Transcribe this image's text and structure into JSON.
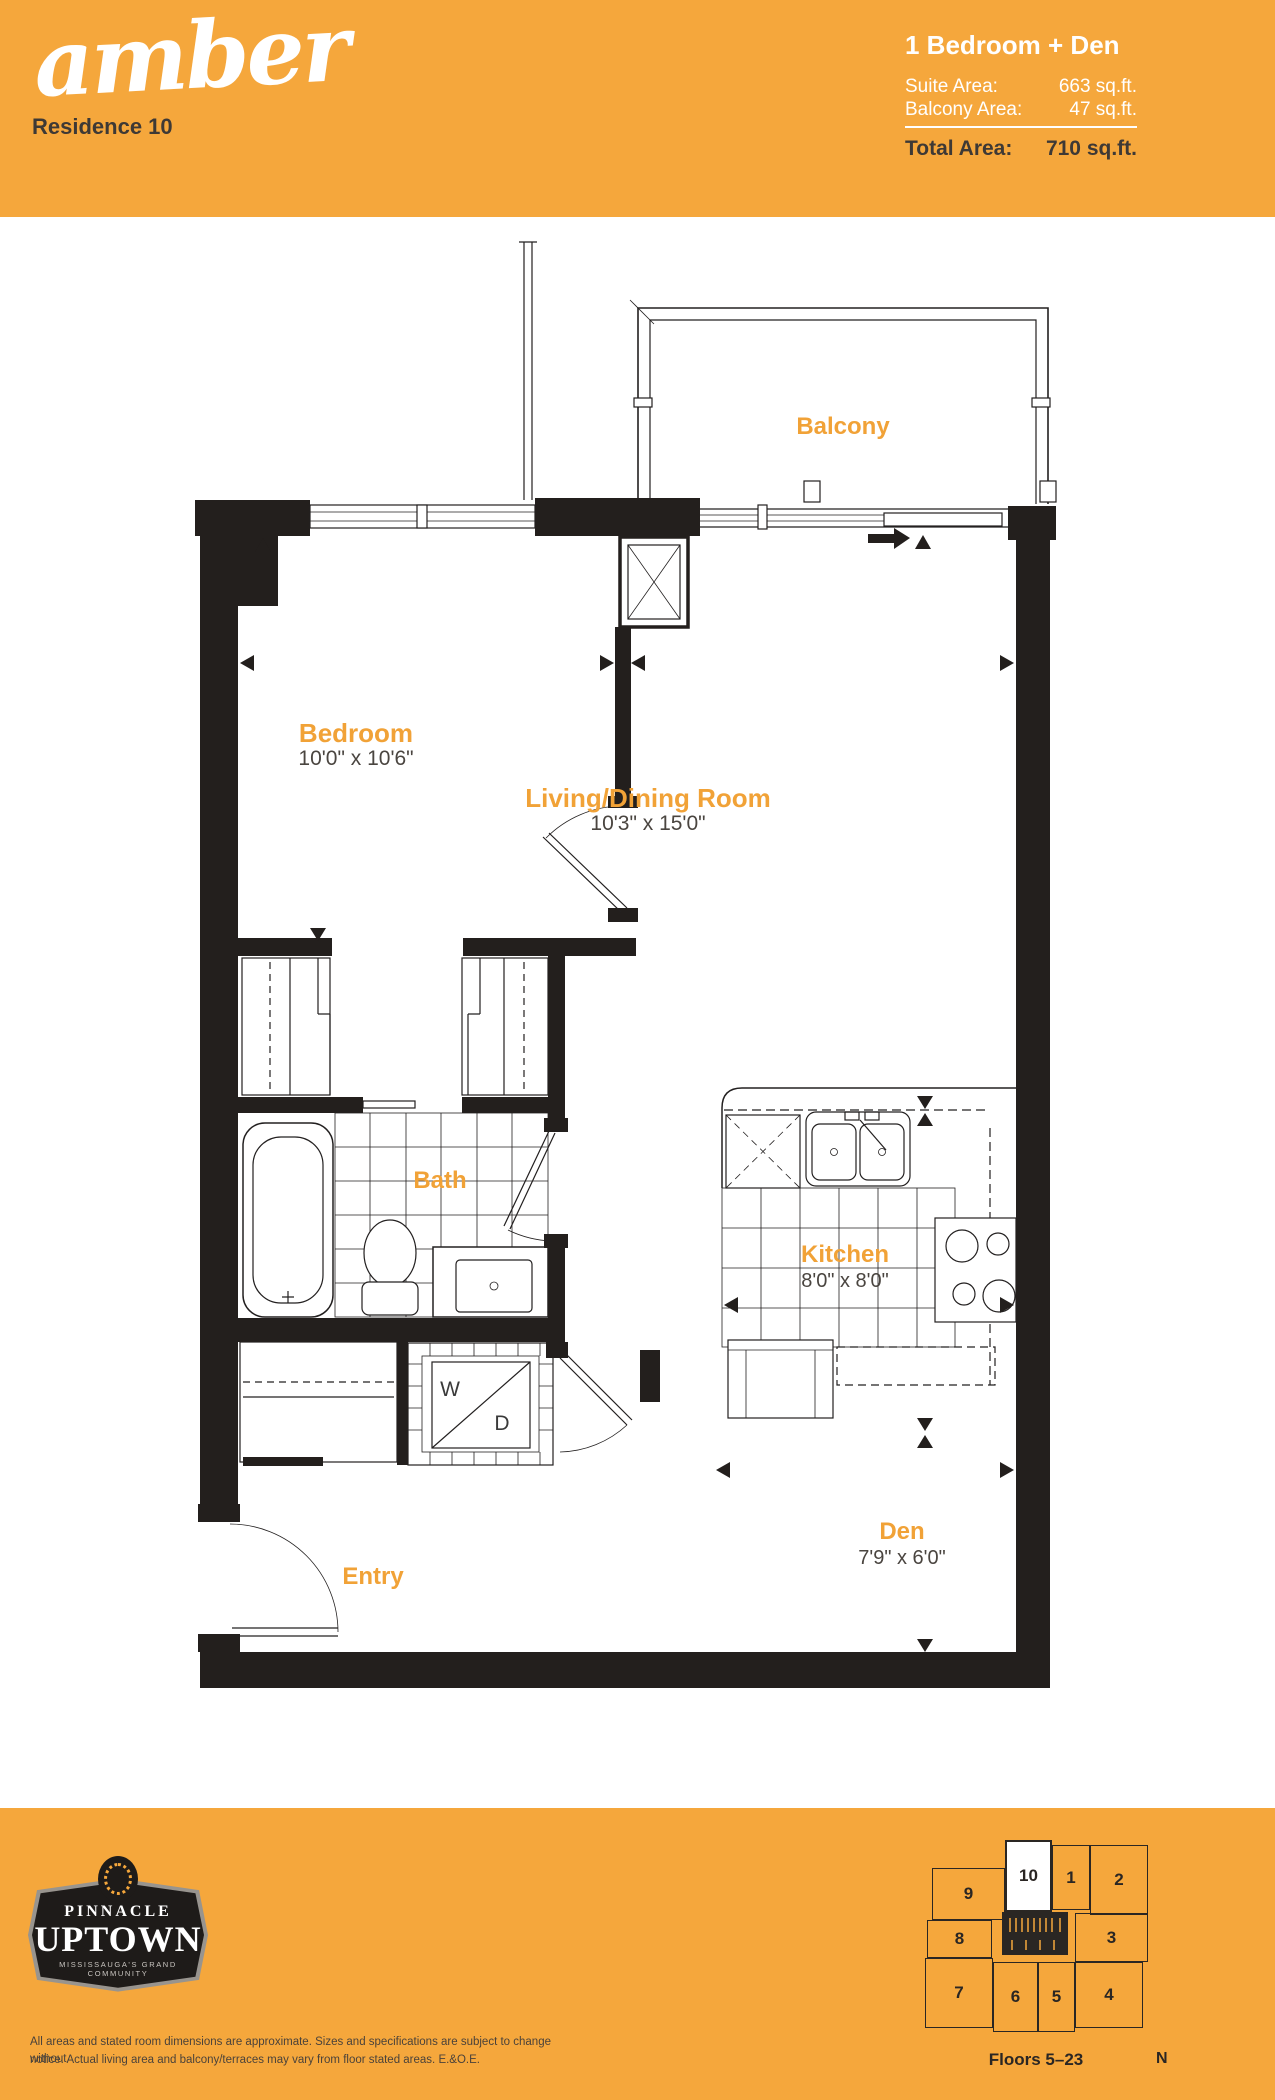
{
  "header": {
    "brand": "amber",
    "residence": "Residence 10",
    "unit_type": "1 Bedroom + Den",
    "suite_area_label": "Suite Area:",
    "suite_area_value": "663 sq.ft.",
    "balcony_area_label": "Balcony Area:",
    "balcony_area_value": "47 sq.ft.",
    "total_area_label": "Total Area:",
    "total_area_value": "710 sq.ft."
  },
  "plan": {
    "rooms": [
      {
        "name": "Balcony",
        "dims": ""
      },
      {
        "name": "Bedroom",
        "dims": "10'0\" x 10'6\""
      },
      {
        "name": "Living/Dining Room",
        "dims": "10'3\" x 15'0\""
      },
      {
        "name": "Bath",
        "dims": ""
      },
      {
        "name": "Kitchen",
        "dims": "8'0\" x 8'0\""
      },
      {
        "name": "Den",
        "dims": "7'9\" x 6'0\""
      },
      {
        "name": "Entry",
        "dims": ""
      }
    ],
    "washer_label": "W",
    "dryer_label": "D"
  },
  "footer": {
    "logo": {
      "line1": "PINNACLE",
      "line2": "UPTOWN",
      "tagline": "MISSISSAUGA'S GRAND COMMUNITY"
    },
    "disclaimer_line1": "All areas and stated room dimensions are approximate. Sizes and specifications are subject to change without",
    "disclaimer_line2": "notice. Actual living area and balcony/terraces may vary from floor stated areas. E.&O.E.",
    "keyplan": {
      "units": [
        {
          "label": "10"
        },
        {
          "label": "1"
        },
        {
          "label": "2"
        },
        {
          "label": "9"
        },
        {
          "label": "8"
        },
        {
          "label": "3"
        },
        {
          "label": "7"
        },
        {
          "label": "6"
        },
        {
          "label": "5"
        },
        {
          "label": "4"
        }
      ],
      "floors": "Floors 5–23",
      "north": "N"
    }
  },
  "colors": {
    "accent_orange": "#F5A73C",
    "label_orange": "#F1A237",
    "dark_text": "#3E3935",
    "wall_black": "#231F1D"
  }
}
